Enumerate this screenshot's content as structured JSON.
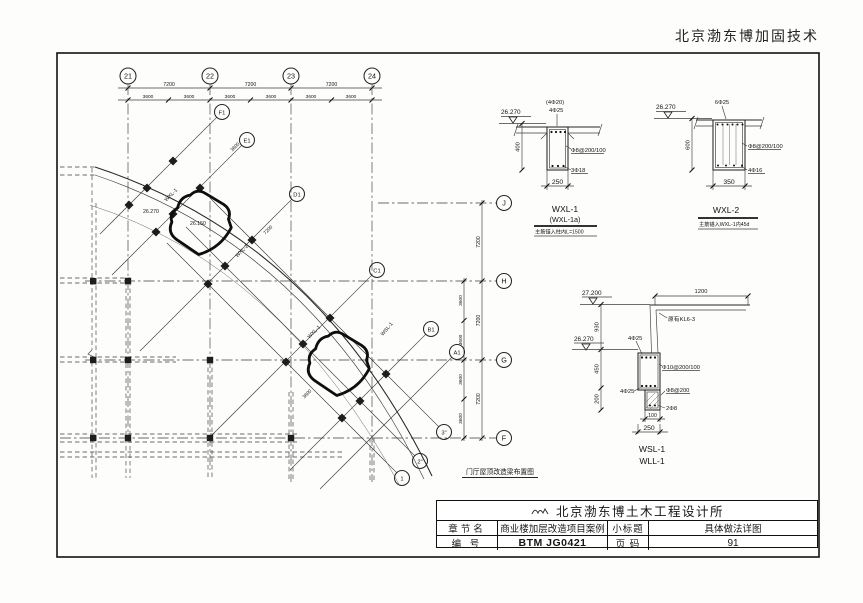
{
  "header": {
    "stamp": "北京渤东博加固技术"
  },
  "plan": {
    "title": "门厅屋顶改造梁布置图",
    "axes_top": [
      "21",
      "22",
      "23",
      "24"
    ],
    "axes_right": [
      "J",
      "H",
      "G",
      "F"
    ],
    "axes_diag": [
      "F1",
      "E1",
      "D1",
      "C1",
      "B1",
      "A1"
    ],
    "axes_bottom": [
      "3\"",
      "2\"",
      "1"
    ],
    "dim_major": "7200",
    "dim_minor": "3600",
    "labels": {
      "elev_a": "26.270",
      "elev_b": "26.150",
      "wxl1": "WXL-1",
      "wxl2": "WXL-2",
      "wsl1": "WSL-1"
    }
  },
  "details": {
    "wxl1": {
      "elevation": "26.270",
      "rebar_top_alt": "(4Φ20)",
      "rebar_top": "4Φ25",
      "stirrup": "Φ8@200/100",
      "rebar_bottom": "3Φ18",
      "dim_height": "400",
      "dim_width": "250",
      "name": "WXL-1",
      "name_alt": "(WXL-1a)",
      "note": "主筋锚入柱内L=1500"
    },
    "wxl2": {
      "elevation": "26.270",
      "rebar_top": "6Φ25",
      "stirrup": "Φ8@200/100",
      "rebar_bottom": "4Φ16",
      "dim_height": "600",
      "dim_width": "350",
      "name": "WXL-2",
      "note": "主筋锚入WXL-1内45d"
    },
    "wsl1": {
      "elev_top": "27.200",
      "elev_mid": "26.270",
      "dim_overhang": "1200",
      "existing_beam": "原有KL6-3",
      "dim_930": "930",
      "dim_450": "450",
      "dim_200": "200",
      "rebar_top": "4Φ25",
      "stirrup_main": "Φ10@200/100",
      "rebar_mid": "4Φ25",
      "stirrup_lower": "Φ8@200",
      "rebar_bottom": "2Φ8",
      "dim_100": "100",
      "dim_width": "250",
      "name_1": "WSL-1",
      "name_2": "WLL-1"
    }
  },
  "title_block": {
    "company": "北京渤东博土木工程设计所",
    "chapter_label": "章节名",
    "chapter_value": "商业楼加层改造项目案例",
    "subtitle_label": "小标题",
    "subtitle_value": "具体做法详图",
    "number_label": "编 号",
    "number_value": "BTM JG0421",
    "page_label": "页 码",
    "page_value": "91"
  }
}
